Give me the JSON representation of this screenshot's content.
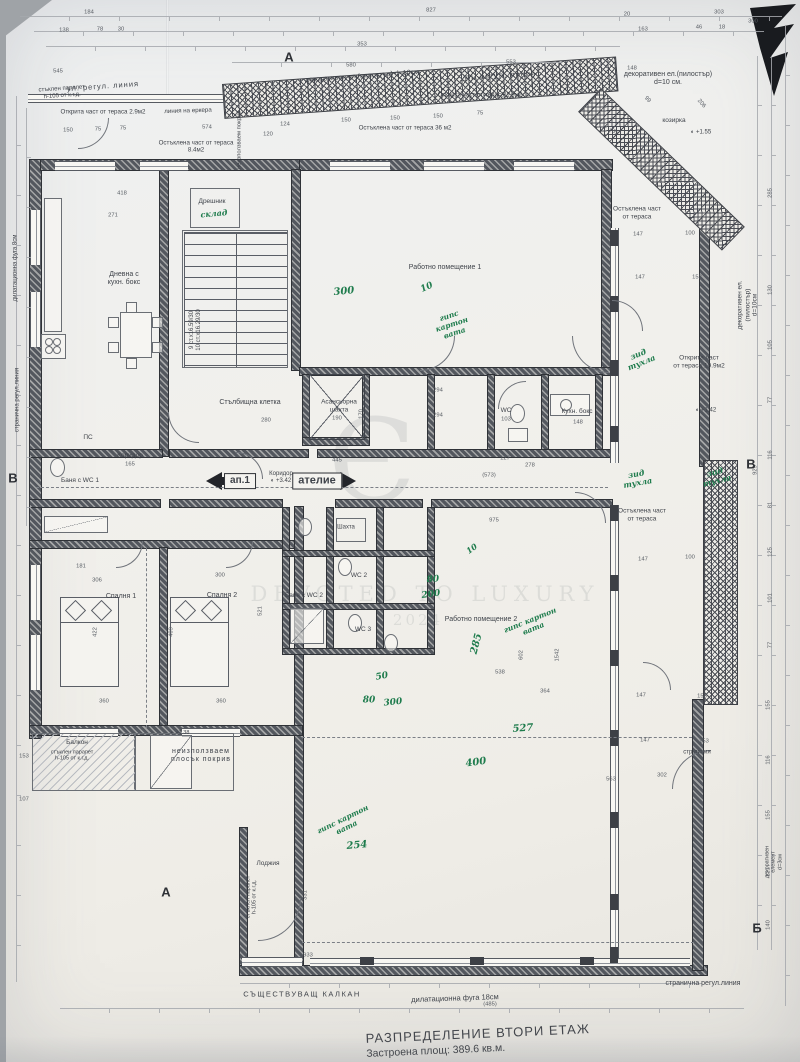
{
  "title": {
    "line1": "РАЗПРЕДЕЛЕНИЕ  ВТОРИ ЕТАЖ",
    "line2": "Застроена площ: 389.6 кв.м."
  },
  "watermark": {
    "monogram": "Є",
    "line": "DEVOTED TO LUXURY",
    "year": "2024"
  },
  "colors": {
    "paper": "#f1f0ec",
    "ink": "#3f434a",
    "green_notes": "#1f7c4d",
    "walls": "#53575e"
  },
  "markers": [
    {
      "t": "А",
      "x": 289,
      "y": 57,
      "fs": 13
    },
    {
      "t": "А",
      "x": 166,
      "y": 892,
      "fs": 13
    },
    {
      "t": "Б",
      "x": 757,
      "y": 928,
      "fs": 13
    },
    {
      "t": "В",
      "x": 13,
      "y": 478,
      "fs": 13
    },
    {
      "t": "В",
      "x": 751,
      "y": 464,
      "fs": 13
    }
  ],
  "labels": [
    {
      "t": "ул. регул. линия",
      "x": 103,
      "y": 87,
      "fs": 7.5,
      "rot": -4,
      "ls": 1
    },
    {
      "t": "стъклен парапет\nh-105 от к.г.д.",
      "x": 62,
      "y": 93,
      "fs": 6,
      "rot": -4
    },
    {
      "t": "Открита част от тераса 2.9м2",
      "x": 103,
      "y": 112,
      "fs": 6.2
    },
    {
      "t": "линия на еркера",
      "x": 188,
      "y": 111,
      "fs": 6.2,
      "rot": -2
    },
    {
      "t": "Остъклена част от тераса\n8.4м2",
      "x": 196,
      "y": 147,
      "fs": 6.2
    },
    {
      "t": "декоративен ел.(пилостър) d=10см.",
      "x": 363,
      "y": 77,
      "fs": 7,
      "rot": -4
    },
    {
      "t": "ул. регул. линия",
      "x": 500,
      "y": 76,
      "fs": 7.5,
      "rot": -3,
      "ls": 1
    },
    {
      "t": "Открита част от тераса 1.9м2",
      "x": 480,
      "y": 95,
      "fs": 6.2
    },
    {
      "t": "Остъклена част от тераса 36 м2",
      "x": 405,
      "y": 128,
      "fs": 6.2
    },
    {
      "t": "козирка",
      "x": 674,
      "y": 121,
      "fs": 6.5
    },
    {
      "t": "декоративен ел.(пилостър)\nd=10 см.",
      "x": 668,
      "y": 79,
      "fs": 7
    },
    {
      "t": "неизползваем покрив",
      "x": 240,
      "y": 140,
      "fs": 5.8,
      "rot": -90
    },
    {
      "t": "Дрешник",
      "x": 212,
      "y": 202,
      "fs": 6.5
    },
    {
      "t": "Дневна с\nкухн. бокс",
      "x": 124,
      "y": 279,
      "fs": 7
    },
    {
      "t": "Работно помещение 1",
      "x": 445,
      "y": 268,
      "fs": 7
    },
    {
      "t": "Стълбищна клетка",
      "x": 250,
      "y": 403,
      "fs": 7
    },
    {
      "t": "Асансьорна\nшахта",
      "x": 339,
      "y": 406,
      "fs": 6.5
    },
    {
      "t": "9 ст.х16.59/30\n10 ст.х16.29/30",
      "x": 196,
      "y": 330,
      "fs": 6,
      "rot": -90
    },
    {
      "t": "Коридор",
      "x": 130,
      "y": 456,
      "fs": 6.5
    },
    {
      "t": "ПС",
      "x": 88,
      "y": 438,
      "fs": 6.5
    },
    {
      "t": "Баня с WC 1",
      "x": 80,
      "y": 481,
      "fs": 6.5
    },
    {
      "t": "Коридор\n◐ +3.42",
      "x": 281,
      "y": 478,
      "fs": 6
    },
    {
      "t": "WC",
      "x": 506,
      "y": 411,
      "fs": 6.5
    },
    {
      "t": "Кухн. бокс",
      "x": 577,
      "y": 412,
      "fs": 6.5
    },
    {
      "t": "Шахта",
      "x": 346,
      "y": 528,
      "fs": 6
    },
    {
      "t": "WC 2",
      "x": 359,
      "y": 576,
      "fs": 6.5
    },
    {
      "t": "Баня с WC 2",
      "x": 304,
      "y": 596,
      "fs": 6.5
    },
    {
      "t": "WC 3",
      "x": 363,
      "y": 630,
      "fs": 6.5
    },
    {
      "t": "Спалня 1",
      "x": 121,
      "y": 597,
      "fs": 7
    },
    {
      "t": "Спалня 2",
      "x": 222,
      "y": 596,
      "fs": 7
    },
    {
      "t": "Работно помещение 2",
      "x": 481,
      "y": 620,
      "fs": 7
    },
    {
      "t": "Балкон",
      "x": 77,
      "y": 743,
      "fs": 6.5
    },
    {
      "t": "стъклен парапет\nh-105 от к.г.д.",
      "x": 72,
      "y": 756,
      "fs": 5.5
    },
    {
      "t": "неизползваем\nплосък покрив",
      "x": 201,
      "y": 756,
      "fs": 7,
      "ls": 1
    },
    {
      "t": "Лоджия",
      "x": 268,
      "y": 864,
      "fs": 6.5
    },
    {
      "t": "стъклен парапет\nh-105 от к.г.д.",
      "x": 252,
      "y": 897,
      "fs": 5.5,
      "rot": -90
    },
    {
      "t": "Остъклена част\nот тераса",
      "x": 637,
      "y": 213,
      "fs": 6.5
    },
    {
      "t": "Открита част\nот тераса 19.9м2",
      "x": 699,
      "y": 362,
      "fs": 6.5
    },
    {
      "t": "Остъклена част\nот тераса",
      "x": 642,
      "y": 515,
      "fs": 6.5
    },
    {
      "t": "декоративен  ел.(пилостър)\nd=10см",
      "x": 748,
      "y": 305,
      "fs": 6.5,
      "rot": -90
    },
    {
      "t": "декоративен елемент d=3см",
      "x": 774,
      "y": 862,
      "fs": 5.5,
      "rot": -90
    },
    {
      "t": "дилатационна фуга 8см",
      "x": 16,
      "y": 268,
      "fs": 6,
      "rot": -90
    },
    {
      "t": "странична регул.линия",
      "x": 18,
      "y": 400,
      "fs": 6,
      "rot": -90
    },
    {
      "t": "СЪЩЕСТВУВАЩ  КАЛКАН",
      "x": 302,
      "y": 995,
      "fs": 7.5,
      "ls": 1.5
    },
    {
      "t": "дилатационна фуга 18см",
      "x": 455,
      "y": 999,
      "fs": 7.5,
      "rot": -2
    },
    {
      "t": "странична регул.линия",
      "x": 703,
      "y": 984,
      "fs": 7
    },
    {
      "t": "стр.линия",
      "x": 697,
      "y": 753,
      "fs": 6
    },
    {
      "t": "◐ +1.55",
      "x": 701,
      "y": 133,
      "fs": 6
    },
    {
      "t": "◐ +1.42",
      "x": 706,
      "y": 411,
      "fs": 6
    },
    {
      "t": "◐ +1.38",
      "x": 180,
      "y": 733,
      "fs": 5.5
    },
    {
      "t": "ап.1",
      "x": 240,
      "y": 481,
      "fs": 10,
      "cls": "boxed",
      "n": "apartment-label-box"
    },
    {
      "t": "ателие",
      "x": 317,
      "y": 481,
      "fs": 11,
      "cls": "boxed",
      "n": "atelier-label-box"
    }
  ],
  "green_notes": [
    {
      "t": "склад",
      "x": 214,
      "y": 214,
      "fs": 8,
      "rot": -5
    },
    {
      "t": "300",
      "x": 344,
      "y": 292,
      "fs": 10,
      "rot": -6
    },
    {
      "t": "10",
      "x": 427,
      "y": 288,
      "fs": 9,
      "rot": -25
    },
    {
      "t": "гипс\nкартон\nвата",
      "x": 452,
      "y": 325,
      "fs": 7.5,
      "rot": -18
    },
    {
      "t": "зид\nтухла",
      "x": 640,
      "y": 359,
      "fs": 8,
      "rot": -22
    },
    {
      "t": "зид\nтухла",
      "x": 637,
      "y": 479,
      "fs": 8,
      "rot": -10
    },
    {
      "t": "зид\nтухла",
      "x": 716,
      "y": 477,
      "fs": 8,
      "rot": -14
    },
    {
      "t": "10",
      "x": 472,
      "y": 549,
      "fs": 8,
      "rot": -35
    },
    {
      "t": "80",
      "x": 433,
      "y": 580,
      "fs": 9,
      "rot": -5
    },
    {
      "t": "200",
      "x": 431,
      "y": 595,
      "fs": 9,
      "rot": -8
    },
    {
      "t": "285",
      "x": 477,
      "y": 644,
      "fs": 10,
      "rot": -75
    },
    {
      "t": "гипс картон\nвата",
      "x": 532,
      "y": 625,
      "fs": 7.5,
      "rot": -22
    },
    {
      "t": "50",
      "x": 382,
      "y": 677,
      "fs": 9,
      "rot": -10
    },
    {
      "t": "80",
      "x": 369,
      "y": 701,
      "fs": 9
    },
    {
      "t": "300",
      "x": 393,
      "y": 703,
      "fs": 9,
      "rot": -6
    },
    {
      "t": "527",
      "x": 523,
      "y": 729,
      "fs": 10,
      "rot": -4
    },
    {
      "t": "400",
      "x": 476,
      "y": 763,
      "fs": 10,
      "rot": -8
    },
    {
      "t": "254",
      "x": 357,
      "y": 846,
      "fs": 10,
      "rot": -5
    },
    {
      "t": "гипс картон\nвата",
      "x": 345,
      "y": 824,
      "fs": 7.5,
      "rot": -26
    }
  ],
  "dim_labels": [
    {
      "t": "184",
      "x": 89,
      "y": 13
    },
    {
      "t": "827",
      "x": 431,
      "y": 11
    },
    {
      "t": "20",
      "x": 627,
      "y": 15
    },
    {
      "t": "303",
      "x": 719,
      "y": 13
    },
    {
      "t": "300",
      "x": 753,
      "y": 22
    },
    {
      "t": "138",
      "x": 64,
      "y": 31
    },
    {
      "t": "78",
      "x": 100,
      "y": 30
    },
    {
      "t": "30",
      "x": 121,
      "y": 30
    },
    {
      "t": "353",
      "x": 362,
      "y": 45
    },
    {
      "t": "580",
      "x": 351,
      "y": 66
    },
    {
      "t": "553",
      "x": 511,
      "y": 63
    },
    {
      "t": "163",
      "x": 643,
      "y": 30
    },
    {
      "t": "46",
      "x": 699,
      "y": 28
    },
    {
      "t": "18",
      "x": 722,
      "y": 28
    },
    {
      "t": "545",
      "x": 58,
      "y": 72
    },
    {
      "t": "148",
      "x": 632,
      "y": 69
    },
    {
      "t": "150",
      "x": 68,
      "y": 131
    },
    {
      "t": "75",
      "x": 98,
      "y": 130
    },
    {
      "t": "75",
      "x": 123,
      "y": 129
    },
    {
      "t": "574",
      "x": 207,
      "y": 128
    },
    {
      "t": "124",
      "x": 285,
      "y": 125
    },
    {
      "t": "120",
      "x": 268,
      "y": 135
    },
    {
      "t": "150",
      "x": 346,
      "y": 121
    },
    {
      "t": "150",
      "x": 395,
      "y": 119
    },
    {
      "t": "150",
      "x": 438,
      "y": 117
    },
    {
      "t": "75",
      "x": 480,
      "y": 114
    },
    {
      "t": "99",
      "x": 647,
      "y": 100,
      "rot": 48
    },
    {
      "t": "206",
      "x": 701,
      "y": 104,
      "rot": 48
    },
    {
      "t": "237",
      "x": 613,
      "y": 132,
      "rot": 48
    },
    {
      "t": "418",
      "x": 122,
      "y": 194
    },
    {
      "t": "271",
      "x": 113,
      "y": 216
    },
    {
      "t": "147",
      "x": 638,
      "y": 235
    },
    {
      "t": "100",
      "x": 690,
      "y": 234
    },
    {
      "t": "147",
      "x": 640,
      "y": 278
    },
    {
      "t": "153",
      "x": 697,
      "y": 278
    },
    {
      "t": "280",
      "x": 266,
      "y": 421
    },
    {
      "t": "190",
      "x": 337,
      "y": 419
    },
    {
      "t": "170",
      "x": 362,
      "y": 414,
      "rot": -90
    },
    {
      "t": "103",
      "x": 506,
      "y": 420
    },
    {
      "t": "148",
      "x": 578,
      "y": 423
    },
    {
      "t": "294",
      "x": 438,
      "y": 391
    },
    {
      "t": "294",
      "x": 438,
      "y": 416
    },
    {
      "t": "127",
      "x": 505,
      "y": 459
    },
    {
      "t": "278",
      "x": 530,
      "y": 466
    },
    {
      "t": "(573)",
      "x": 489,
      "y": 476
    },
    {
      "t": "445",
      "x": 337,
      "y": 461
    },
    {
      "t": "165",
      "x": 130,
      "y": 465
    },
    {
      "t": "975",
      "x": 494,
      "y": 521
    },
    {
      "t": "147",
      "x": 643,
      "y": 560
    },
    {
      "t": "100",
      "x": 690,
      "y": 558
    },
    {
      "t": "147",
      "x": 641,
      "y": 696
    },
    {
      "t": "153",
      "x": 702,
      "y": 697
    },
    {
      "t": "181",
      "x": 81,
      "y": 567
    },
    {
      "t": "306",
      "x": 97,
      "y": 581
    },
    {
      "t": "300",
      "x": 220,
      "y": 576
    },
    {
      "t": "422",
      "x": 96,
      "y": 632,
      "rot": -90
    },
    {
      "t": "409",
      "x": 172,
      "y": 632,
      "rot": -90
    },
    {
      "t": "521",
      "x": 261,
      "y": 611,
      "rot": -90
    },
    {
      "t": "360",
      "x": 104,
      "y": 702
    },
    {
      "t": "360",
      "x": 221,
      "y": 702
    },
    {
      "t": "602",
      "x": 522,
      "y": 655,
      "rot": -90
    },
    {
      "t": "1542",
      "x": 558,
      "y": 655,
      "rot": -90
    },
    {
      "t": "538",
      "x": 500,
      "y": 673
    },
    {
      "t": "364",
      "x": 545,
      "y": 692
    },
    {
      "t": "563",
      "x": 611,
      "y": 780
    },
    {
      "t": "302",
      "x": 662,
      "y": 776
    },
    {
      "t": "147",
      "x": 645,
      "y": 741
    },
    {
      "t": "153",
      "x": 704,
      "y": 742
    },
    {
      "t": "331",
      "x": 306,
      "y": 895,
      "rot": -90
    },
    {
      "t": "933",
      "x": 308,
      "y": 956
    },
    {
      "t": "(485)",
      "x": 490,
      "y": 1005
    },
    {
      "t": "153",
      "x": 24,
      "y": 757
    },
    {
      "t": "107",
      "x": 24,
      "y": 800
    },
    {
      "t": "929",
      "x": 756,
      "y": 470,
      "rot": -90
    },
    {
      "t": "285",
      "x": 771,
      "y": 193,
      "rot": -90
    },
    {
      "t": "130",
      "x": 771,
      "y": 290,
      "rot": -90
    },
    {
      "t": "105",
      "x": 771,
      "y": 345,
      "rot": -90
    },
    {
      "t": "77",
      "x": 771,
      "y": 400,
      "rot": -90
    },
    {
      "t": "116",
      "x": 771,
      "y": 455,
      "rot": -90
    },
    {
      "t": "81",
      "x": 771,
      "y": 505,
      "rot": -90
    },
    {
      "t": "125",
      "x": 771,
      "y": 552,
      "rot": -90
    },
    {
      "t": "101",
      "x": 771,
      "y": 598,
      "rot": -90
    },
    {
      "t": "77",
      "x": 771,
      "y": 645,
      "rot": -90
    },
    {
      "t": "155",
      "x": 769,
      "y": 705,
      "rot": -90
    },
    {
      "t": "116",
      "x": 769,
      "y": 760,
      "rot": -90
    },
    {
      "t": "155",
      "x": 769,
      "y": 815,
      "rot": -90
    },
    {
      "t": "121",
      "x": 769,
      "y": 872,
      "rot": -90
    },
    {
      "t": "140",
      "x": 769,
      "y": 925,
      "rot": -90
    }
  ]
}
